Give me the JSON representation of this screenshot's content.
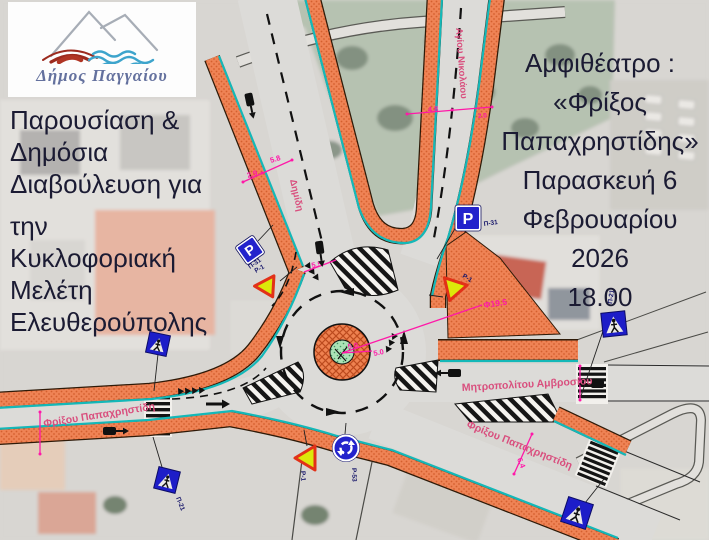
{
  "slide": {
    "logo": {
      "municipality_name": "Δήμος Παγγαίου"
    },
    "announcement": {
      "lines": [
        "Παρουσίαση &",
        "Δημόσια",
        "Διαβούλευση για",
        "την",
        "Κυκλοφοριακή",
        "Μελέτη",
        "Ελευθερούπολης"
      ]
    },
    "event": {
      "lines": [
        "Αμφιθέατρο :",
        "«Φρίξος",
        "Παπαχρηστίδης»",
        "Παρασκευή 6",
        "Φεβρουαρίου 2026",
        "18.00"
      ]
    }
  },
  "map": {
    "streets": {
      "north": "Δημίδη",
      "northeast": "Αγίου Νικολάου",
      "west": "Φρίξου Παπαχρηστίδη",
      "east": "Μητροπολίτου Αμβροσίου",
      "southeast": "Φρίξου Παπαχρηστίδη"
    },
    "signs": {
      "parking_symbol": "P",
      "parking_west_code": "Π-31",
      "parking_east_code": "Π-31",
      "yield_west_code": "Ρ-1",
      "yield_east_code": "Ρ-1",
      "yield_south_code": "Ρ-1",
      "roundabout_code": "Ρ-53",
      "crosswalk_southwest_code": "Π-21",
      "crosswalk_east_code": "Π-21"
    },
    "dimensions": {
      "dimidi_lane": "2.9",
      "dimidi_width": "5.8",
      "agiou_nikolaou_width": "4.8",
      "agiou_nikolaou_parking": "2.0",
      "north_entry": "5.5",
      "circulating_lane": "5.0",
      "circulating_lane_2": "5.0",
      "inscribed_diameter": "Φ19.5",
      "southeast_width": "6.4"
    },
    "colors": {
      "sidewalk_orange": "#ef8355",
      "curb_teal": "#14b8b8",
      "street_label_pink": "#d94f7e",
      "dimension_magenta": "#ff18a8",
      "sign_blue": "#2323cc",
      "title_navy": "#1b1b33"
    }
  }
}
